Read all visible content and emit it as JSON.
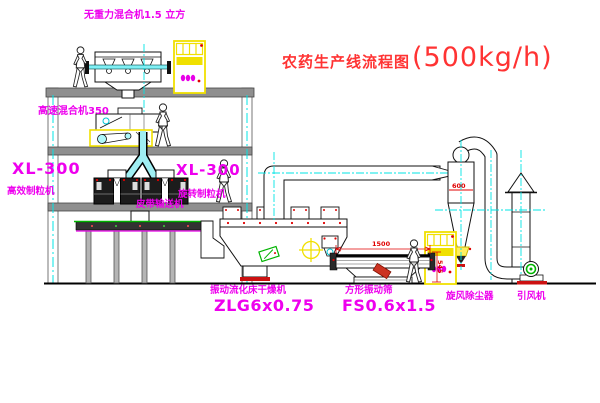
{
  "title": {
    "name": "农药生产线流程图",
    "capacity": "(500kg/h)"
  },
  "labels": {
    "gravity_mixer": "无重力混合机1.5 立方",
    "high_speed_mixer": "高速混合机350",
    "granulator_left_model": "XL-300",
    "granulator_left_name": "高效制粒机",
    "granulator_right_model": "XL-300",
    "granulator_right_name": "旋转制粒机",
    "belt_conveyor": "皮带输送机",
    "fluid_bed_dryer_name": "振动流化床干燥机",
    "fluid_bed_dryer_model": "ZLG6x0.75",
    "square_sieve_name": "方形振动筛",
    "square_sieve_model": "FS0.6x1.5",
    "cyclone_dust_collector": "旋风除尘器",
    "induced_draft_fan": "引风机"
  },
  "dimensions": {
    "sieve_length": "1500",
    "sieve_height": "545",
    "cyclone_width": "600"
  },
  "colors": {
    "label_magenta": "#ee00ee",
    "title_red": "#ff3333",
    "dimension_red": "#e00000",
    "equipment_yellow": "#f0e000",
    "centerline_cyan": "#00e5e5",
    "conveyor_green": "#00b400"
  }
}
